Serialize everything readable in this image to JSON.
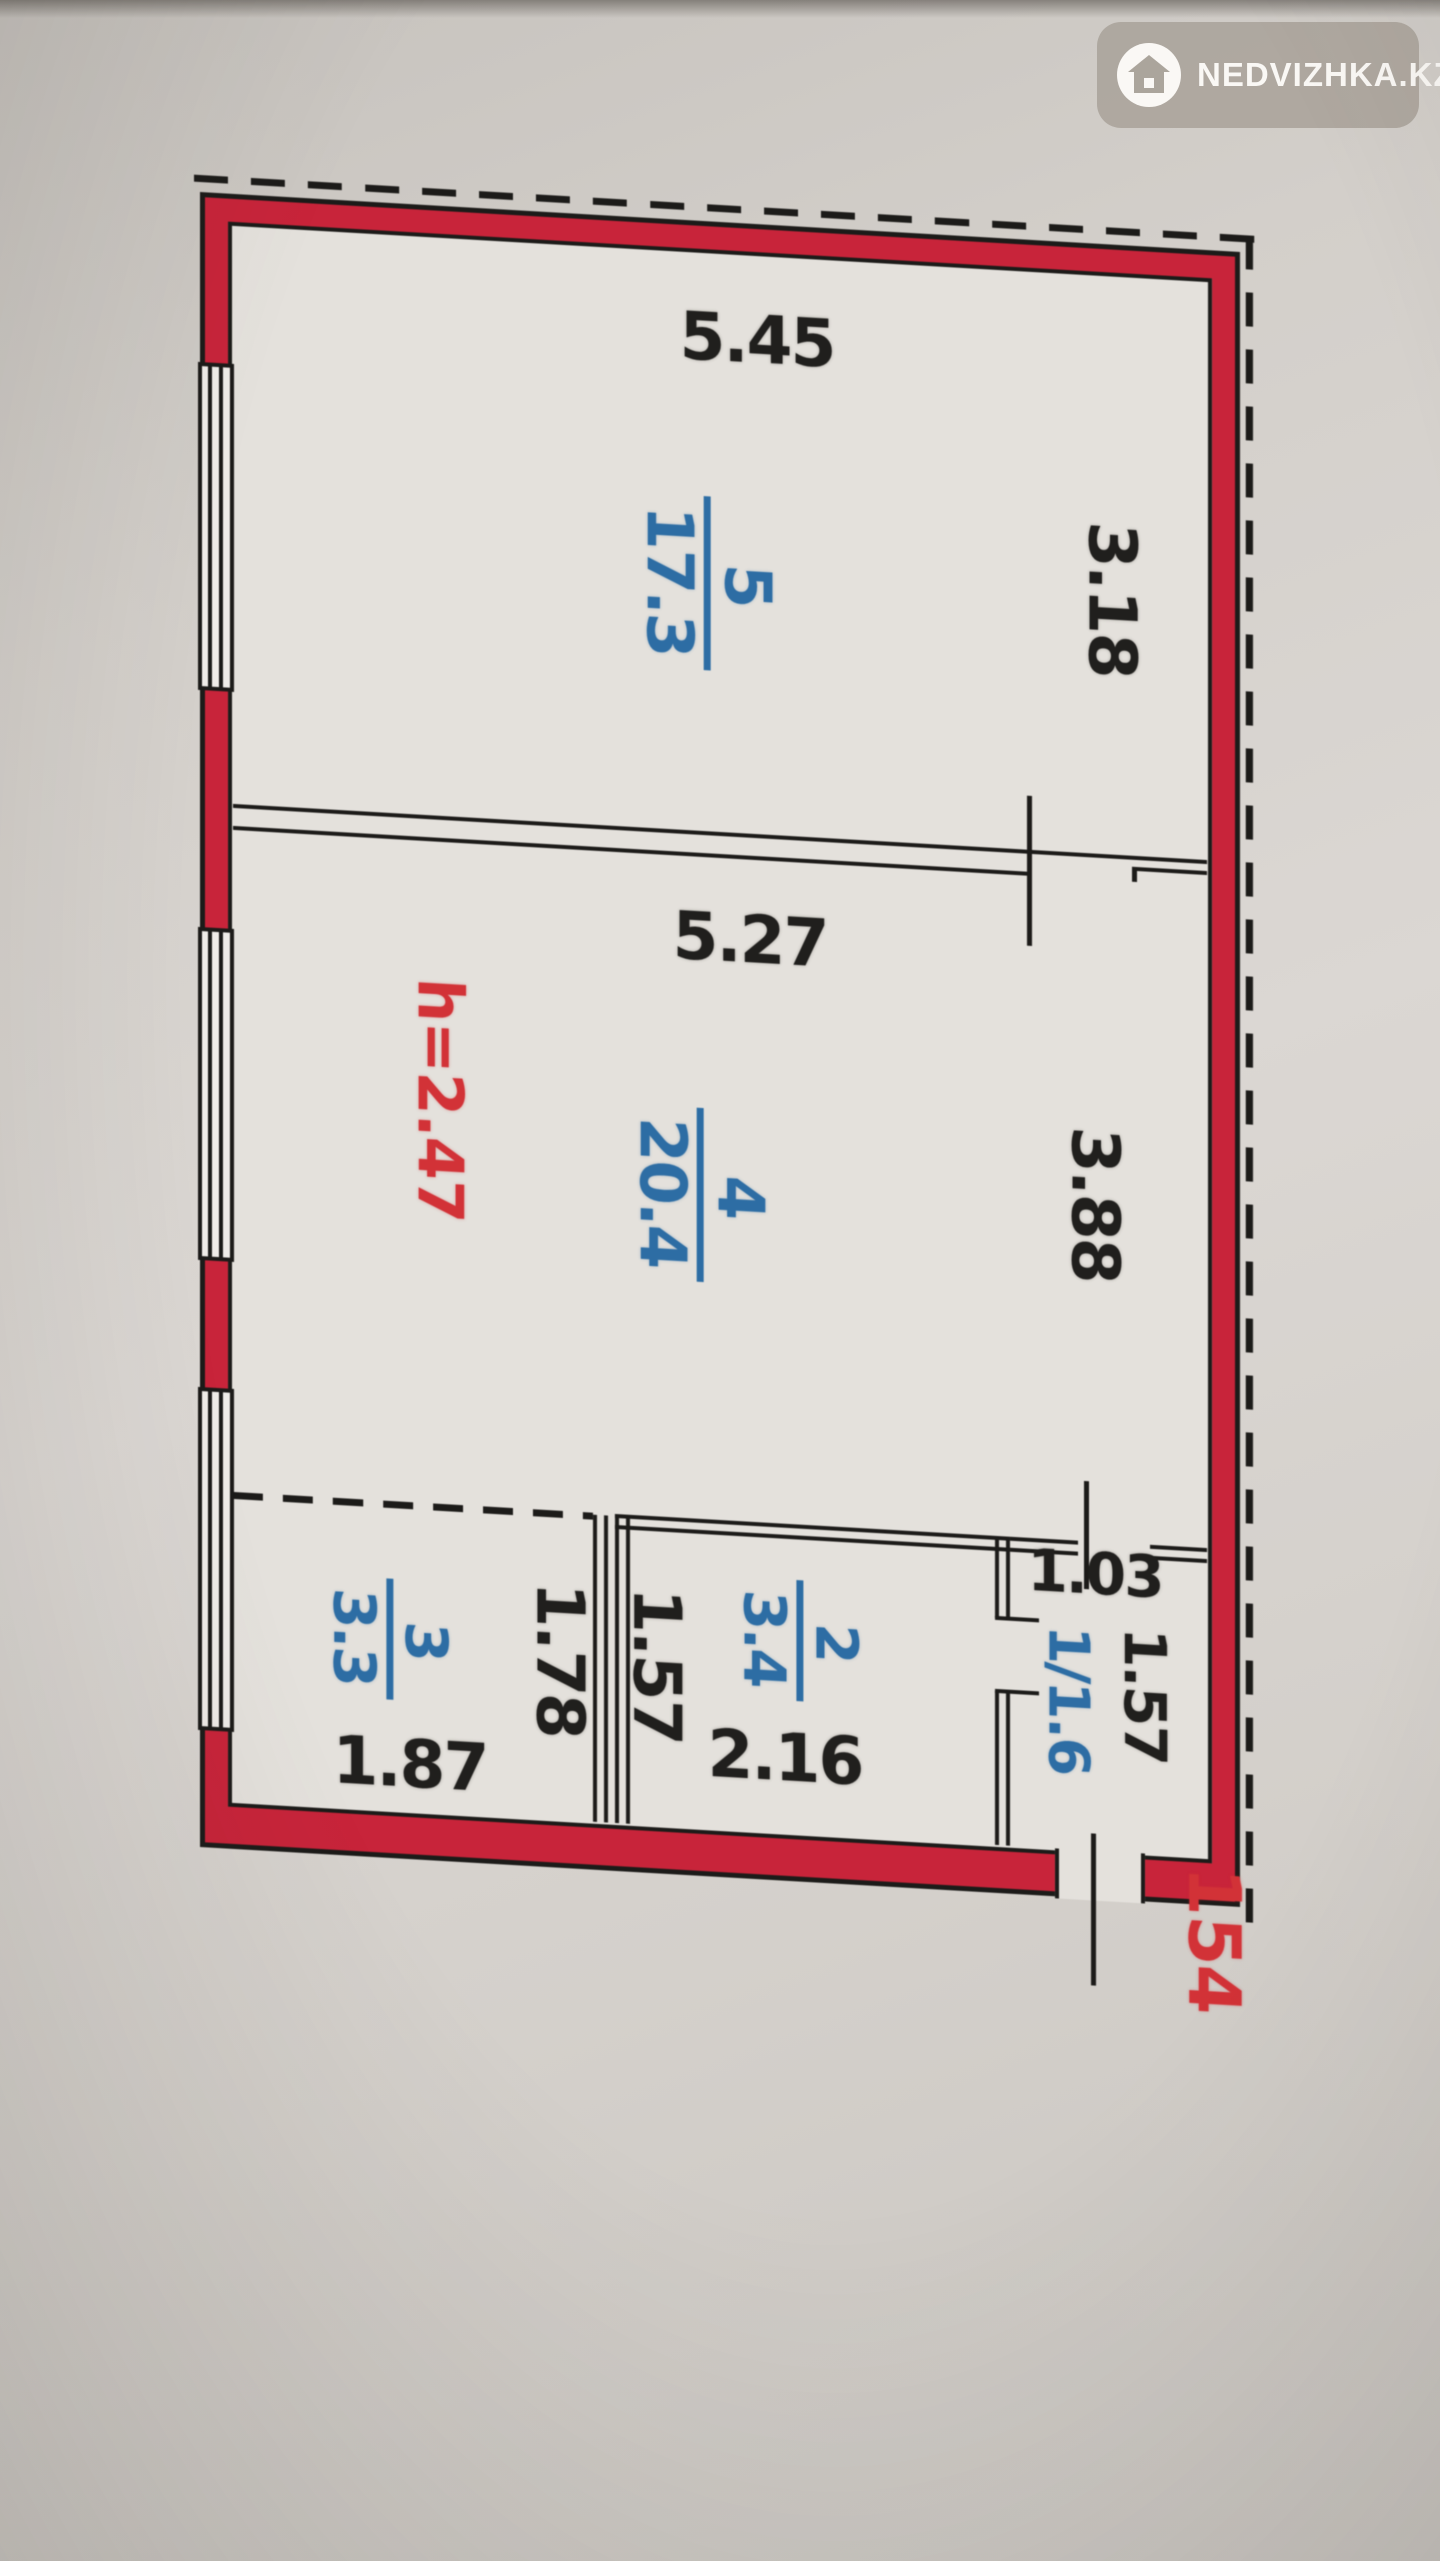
{
  "watermark": {
    "brand": "NEDVIZHKA.KZ"
  },
  "floor_plan": {
    "height_note": "h=2.47",
    "unit_number": "154",
    "rooms": {
      "r5": {
        "number": "5",
        "area": "17.3"
      },
      "r4": {
        "number": "4",
        "area": "20.4"
      },
      "r3": {
        "number": "3",
        "area": "3.3"
      },
      "r2": {
        "number": "2",
        "area": "3.4"
      },
      "r1": {
        "label": "1/1.6"
      }
    },
    "dimensions": {
      "room5_width": "5.45",
      "room5_depth": "3.18",
      "room4_width": "5.27",
      "room4_depth": "3.88",
      "room3_width": "1.87",
      "room3_depth": "1.78",
      "room2_height": "1.57",
      "room2_width": "2.16",
      "room1_width": "1.03",
      "room1_depth": "1.57"
    },
    "colors": {
      "wall": "#c8243a",
      "room_label": "#2d6da4",
      "accent_text": "#d23237",
      "line": "#1c1b19"
    }
  }
}
